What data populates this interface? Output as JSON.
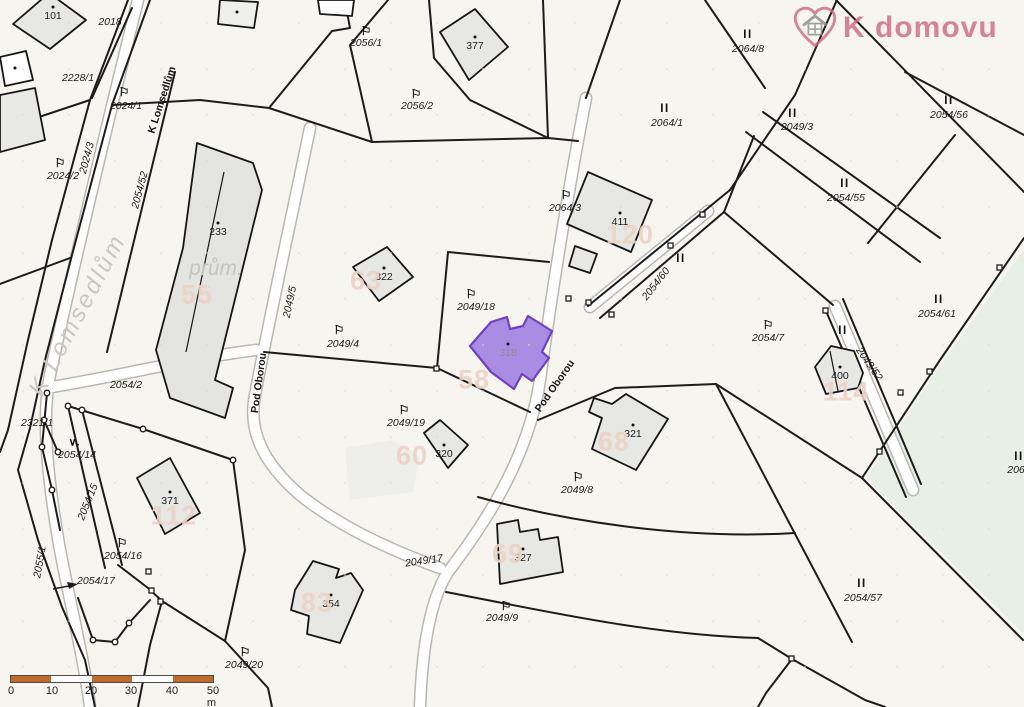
{
  "logo": {
    "text": "K domovu"
  },
  "colors": {
    "highlight_fill": "#aa8ce2",
    "highlight_border": "#7040c8",
    "watermark": "#ecd2c5",
    "brand_pink": "#cf6784",
    "scalebar_orange": "#c06b2c",
    "map_background": "#f7f5f0",
    "green_area": "#e8efe4"
  },
  "symbols": {
    "flag": "⚐",
    "II": "II",
    "V": "∨."
  },
  "highlight": {
    "building_number": "318"
  },
  "scale_bar": {
    "ticks": [
      "0",
      "10",
      "20",
      "30",
      "40",
      "50 m"
    ]
  },
  "map_labels": [
    {
      "n": "parcel-2018",
      "k": "parcel",
      "t": "2018",
      "x": 110,
      "y": 22
    },
    {
      "n": "parcel-2228-1",
      "k": "parcel",
      "t": "2228/1",
      "x": 78,
      "y": 78
    },
    {
      "n": "parcel-2024-1",
      "k": "parcel",
      "t": "2024/1",
      "x": 126,
      "y": 106
    },
    {
      "n": "parcel-2024-2",
      "k": "parcel",
      "t": "2024/2",
      "x": 63,
      "y": 176
    },
    {
      "n": "parcel-2024-3",
      "k": "parcel",
      "t": "2024/3",
      "x": 87,
      "y": 158,
      "r": -75
    },
    {
      "n": "parcel-2054-52",
      "k": "parcel",
      "t": "2054/52",
      "x": 140,
      "y": 190,
      "r": -75
    },
    {
      "n": "parcel-2056-1",
      "k": "parcel",
      "t": "2056/1",
      "x": 366,
      "y": 43
    },
    {
      "n": "parcel-2056-2",
      "k": "parcel",
      "t": "2056/2",
      "x": 417,
      "y": 106
    },
    {
      "n": "parcel-2064-8",
      "k": "parcel",
      "t": "2064/8",
      "x": 748,
      "y": 49
    },
    {
      "n": "parcel-2064-1",
      "k": "parcel",
      "t": "2064/1",
      "x": 667,
      "y": 123
    },
    {
      "n": "parcel-2049-3",
      "k": "parcel",
      "t": "2049/3",
      "x": 797,
      "y": 127
    },
    {
      "n": "parcel-2054-56",
      "k": "parcel",
      "t": "2054/56",
      "x": 949,
      "y": 115
    },
    {
      "n": "parcel-2054-55",
      "k": "parcel",
      "t": "2054/55",
      "x": 846,
      "y": 198
    },
    {
      "n": "parcel-2064-3",
      "k": "parcel",
      "t": "2064/3",
      "x": 565,
      "y": 208
    },
    {
      "n": "parcel-2054-60",
      "k": "parcel",
      "t": "2054/60",
      "x": 656,
      "y": 284,
      "r": -52
    },
    {
      "n": "parcel-2054-61",
      "k": "parcel",
      "t": "2054/61",
      "x": 937,
      "y": 314
    },
    {
      "n": "parcel-2054-7",
      "k": "parcel",
      "t": "2054/7",
      "x": 768,
      "y": 338
    },
    {
      "n": "parcel-2049-52",
      "k": "parcel",
      "t": "2049/52",
      "x": 869,
      "y": 364,
      "r": 55
    },
    {
      "n": "parcel-2049-18",
      "k": "parcel",
      "t": "2049/18",
      "x": 476,
      "y": 307
    },
    {
      "n": "parcel-2049-4",
      "k": "parcel",
      "t": "2049/4",
      "x": 343,
      "y": 344
    },
    {
      "n": "parcel-2049-5",
      "k": "parcel",
      "t": "2049/5",
      "x": 290,
      "y": 302,
      "r": -78
    },
    {
      "n": "parcel-2054-2",
      "k": "parcel",
      "t": "2054/2",
      "x": 126,
      "y": 385
    },
    {
      "n": "parcel-2321-1",
      "k": "parcel",
      "t": "2321/1",
      "x": 37,
      "y": 423
    },
    {
      "n": "parcel-2054-14",
      "k": "parcel",
      "t": "2054/14",
      "x": 77,
      "y": 455
    },
    {
      "n": "parcel-2054-15",
      "k": "parcel",
      "t": "2054/15",
      "x": 88,
      "y": 502,
      "r": -68
    },
    {
      "n": "parcel-2054-16",
      "k": "parcel",
      "t": "2054/16",
      "x": 123,
      "y": 556
    },
    {
      "n": "parcel-2054-17",
      "k": "parcel",
      "t": "2054/17",
      "x": 96,
      "y": 581
    },
    {
      "n": "parcel-2055-1",
      "k": "parcel",
      "t": "2055/1",
      "x": 40,
      "y": 562,
      "r": -80
    },
    {
      "n": "parcel-2049-19",
      "k": "parcel",
      "t": "2049/19",
      "x": 406,
      "y": 423
    },
    {
      "n": "parcel-2049-17",
      "k": "parcel",
      "t": "2049/17",
      "x": 424,
      "y": 561,
      "r": -8
    },
    {
      "n": "parcel-2049-8",
      "k": "parcel",
      "t": "2049/8",
      "x": 577,
      "y": 490
    },
    {
      "n": "parcel-2049-9",
      "k": "parcel",
      "t": "2049/9",
      "x": 502,
      "y": 618
    },
    {
      "n": "parcel-2049-20",
      "k": "parcel",
      "t": "2049/20",
      "x": 244,
      "y": 665
    },
    {
      "n": "parcel-2054-57",
      "k": "parcel",
      "t": "2054/57",
      "x": 863,
      "y": 598
    },
    {
      "n": "parcel-206-partial",
      "k": "parcel",
      "t": "206",
      "x": 1016,
      "y": 470
    },
    {
      "n": "building-101",
      "k": "bnum",
      "t": "101",
      "x": 53,
      "y": 16
    },
    {
      "n": "building-233",
      "k": "bnum",
      "t": "233",
      "x": 218,
      "y": 232
    },
    {
      "n": "building-322",
      "k": "bnum",
      "t": "322",
      "x": 384,
      "y": 277
    },
    {
      "n": "building-377",
      "k": "bnum",
      "t": "377",
      "x": 475,
      "y": 46
    },
    {
      "n": "building-411",
      "k": "bnum",
      "t": "411",
      "x": 620,
      "y": 222
    },
    {
      "n": "building-318",
      "k": "bnum",
      "t": "318",
      "x": 508,
      "y": 353,
      "c": "#8b87a0"
    },
    {
      "n": "building-320",
      "k": "bnum",
      "t": "320",
      "x": 444,
      "y": 454
    },
    {
      "n": "building-354",
      "k": "bnum",
      "t": "354",
      "x": 331,
      "y": 604
    },
    {
      "n": "building-327",
      "k": "bnum",
      "t": "327",
      "x": 523,
      "y": 558
    },
    {
      "n": "building-321",
      "k": "bnum",
      "t": "321",
      "x": 633,
      "y": 434
    },
    {
      "n": "building-371",
      "k": "bnum",
      "t": "371",
      "x": 170,
      "y": 501
    },
    {
      "n": "building-400",
      "k": "bnum",
      "t": "400",
      "x": 840,
      "y": 376
    },
    {
      "n": "building-dot",
      "k": "dot",
      "x": 237,
      "y": 12
    },
    {
      "n": "building-dot",
      "k": "dot",
      "x": 15,
      "y": 68
    },
    {
      "n": "watermark-55",
      "k": "wm",
      "t": "55",
      "x": 197,
      "y": 295
    },
    {
      "n": "watermark-63",
      "k": "wm",
      "t": "63",
      "x": 366,
      "y": 281
    },
    {
      "n": "watermark-120",
      "k": "wm",
      "t": "120",
      "x": 630,
      "y": 235
    },
    {
      "n": "watermark-58",
      "k": "wm",
      "t": "58",
      "x": 474,
      "y": 380
    },
    {
      "n": "watermark-60",
      "k": "wm",
      "t": "60",
      "x": 412,
      "y": 456
    },
    {
      "n": "watermark-83",
      "k": "wm",
      "t": "83",
      "x": 317,
      "y": 603
    },
    {
      "n": "watermark-69",
      "k": "wm",
      "t": "69",
      "x": 508,
      "y": 554
    },
    {
      "n": "watermark-68",
      "k": "wm",
      "t": "68",
      "x": 614,
      "y": 442
    },
    {
      "n": "watermark-112",
      "k": "wm",
      "t": "112",
      "x": 174,
      "y": 516
    },
    {
      "n": "watermark-114",
      "k": "wm",
      "t": "114",
      "x": 846,
      "y": 392
    },
    {
      "n": "street-k-lomsedlum-small",
      "k": "street",
      "t": "K Lomsedlům",
      "x": 162,
      "y": 100,
      "r": -72
    },
    {
      "n": "street-k-lomsedlum-large",
      "k": "bigstreet",
      "t": "K Lomsedlům",
      "x": 78,
      "y": 315,
      "r": -62
    },
    {
      "n": "street-pod-oborou-west",
      "k": "street",
      "t": "Pod Oborou",
      "x": 259,
      "y": 383,
      "r": -82
    },
    {
      "n": "street-pod-oborou-east",
      "k": "street",
      "t": "Pod Oborou",
      "x": 555,
      "y": 386,
      "r": -55
    },
    {
      "n": "label-prum",
      "k": "prum",
      "t": "prům.",
      "x": 216,
      "y": 269
    },
    {
      "n": "flag-symbol",
      "k": "sym",
      "s": "flag",
      "x": 124,
      "y": 92
    },
    {
      "n": "flag-symbol",
      "k": "sym",
      "s": "flag",
      "x": 60,
      "y": 163
    },
    {
      "n": "flag-symbol",
      "k": "sym",
      "s": "flag",
      "x": 366,
      "y": 31
    },
    {
      "n": "flag-symbol",
      "k": "sym",
      "s": "flag",
      "x": 416,
      "y": 94
    },
    {
      "n": "flag-symbol",
      "k": "sym",
      "s": "flag",
      "x": 566,
      "y": 195
    },
    {
      "n": "flag-symbol",
      "k": "sym",
      "s": "flag",
      "x": 768,
      "y": 325
    },
    {
      "n": "flag-symbol",
      "k": "sym",
      "s": "flag",
      "x": 471,
      "y": 294
    },
    {
      "n": "flag-symbol",
      "k": "sym",
      "s": "flag",
      "x": 339,
      "y": 330
    },
    {
      "n": "flag-symbol",
      "k": "sym",
      "s": "flag",
      "x": 122,
      "y": 543
    },
    {
      "n": "flag-symbol",
      "k": "sym",
      "s": "flag",
      "x": 404,
      "y": 410
    },
    {
      "n": "flag-symbol",
      "k": "sym",
      "s": "flag",
      "x": 578,
      "y": 477
    },
    {
      "n": "flag-symbol",
      "k": "sym",
      "s": "flag",
      "x": 506,
      "y": 606
    },
    {
      "n": "flag-symbol",
      "k": "sym",
      "s": "flag",
      "x": 245,
      "y": 652
    },
    {
      "n": "II-symbol",
      "k": "sym",
      "s": "II",
      "x": 748,
      "y": 35
    },
    {
      "n": "II-symbol",
      "k": "sym",
      "s": "II",
      "x": 665,
      "y": 109
    },
    {
      "n": "II-symbol",
      "k": "sym",
      "s": "II",
      "x": 793,
      "y": 114
    },
    {
      "n": "II-symbol",
      "k": "sym",
      "s": "II",
      "x": 949,
      "y": 101
    },
    {
      "n": "II-symbol",
      "k": "sym",
      "s": "II",
      "x": 845,
      "y": 184
    },
    {
      "n": "II-symbol",
      "k": "sym",
      "s": "II",
      "x": 681,
      "y": 259
    },
    {
      "n": "II-symbol",
      "k": "sym",
      "s": "II",
      "x": 939,
      "y": 300
    },
    {
      "n": "II-symbol",
      "k": "sym",
      "s": "II",
      "x": 843,
      "y": 331
    },
    {
      "n": "II-symbol",
      "k": "sym",
      "s": "II",
      "x": 862,
      "y": 584
    },
    {
      "n": "II-symbol",
      "k": "sym",
      "s": "II",
      "x": 1019,
      "y": 457
    },
    {
      "n": "V-symbol",
      "k": "sym",
      "s": "V",
      "x": 74,
      "y": 442
    }
  ]
}
